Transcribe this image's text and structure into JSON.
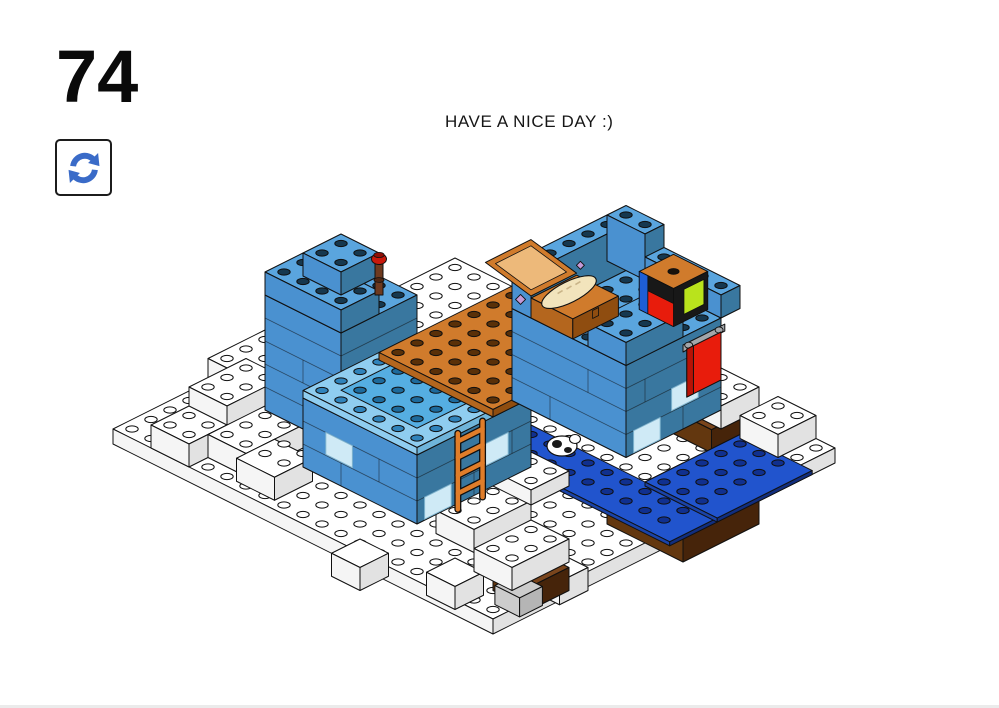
{
  "page": {
    "step_number": "74",
    "message": "HAVE A NICE DAY :)"
  },
  "icons": {
    "rotate_icon_name": "rotate-model-indicator",
    "rotate_icon_glyph": "⟳"
  },
  "colors": {
    "stroke": "#101010",
    "rotate_icon_blue": "#3a6bc8",
    "snow_top": "#ffffff",
    "snow_faceJ": "#f5f5f5",
    "snow_faceI": "#e2e2e2",
    "snow_stud": "#ffffff",
    "blue_top": "#5aa5de",
    "blue_faceJ": "#4a91d0",
    "blue_faceI": "#39779f",
    "blue_stud": "#16384f",
    "lightblue_top": "#8fcdf0",
    "lightblue_stud": "#3083bb",
    "azure_top": "#55aee2",
    "azure_stud": "#1d6a9c",
    "orange_top": "#d07b2c",
    "orange_faceJ": "#b4661e",
    "orange_faceI": "#8f4d10",
    "orange_stud": "#5a3008",
    "ladder_orange": "#e07d2a",
    "water_top": "#2154cd",
    "water_faceJ": "#1a43a8",
    "water_faceI": "#122e7e",
    "water_stud": "#10308f",
    "brown_top": "#7a451c",
    "brown_faceJ": "#63370f",
    "brown_faceI": "#46240a",
    "red": "#e81c0c",
    "red_dark": "#b81205",
    "gray_clip": "#a2a6aa",
    "lime": "#b9e31c",
    "jukebox_blue": "#1e5ed6",
    "jukebox_black": "#181818",
    "tan_bread": "#f2e4bc",
    "tan_line": "#c9b488",
    "trans_fill": "#cfeaf6",
    "trans_stroke": "#7fb4cf",
    "torch_wood": "#6e3a1f",
    "torch_wood_dark": "#4f2713",
    "torch_red": "#c9190c",
    "torch_red_dark": "#8f0f06",
    "slope_gray": "#cccccc",
    "purple": "#c49ad8",
    "chest_inner": "#edb97a"
  }
}
